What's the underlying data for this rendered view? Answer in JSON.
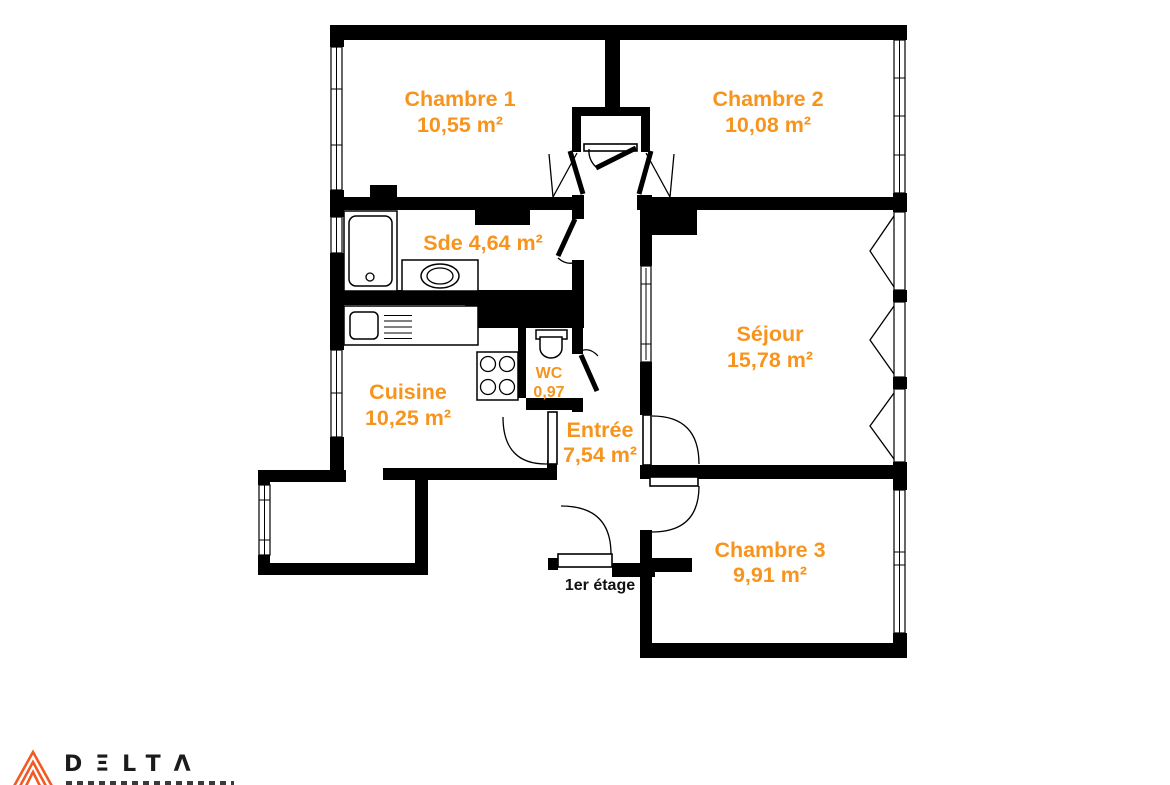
{
  "plan": {
    "floor_label": "1er étage",
    "rooms": {
      "chambre1": {
        "name": "Chambre 1",
        "area": "10,55 m²"
      },
      "chambre2": {
        "name": "Chambre 2",
        "area": "10,08 m²"
      },
      "sde": {
        "label": "Sde 4,64 m²"
      },
      "sejour": {
        "name": "Séjour",
        "area": "15,78 m²"
      },
      "cuisine": {
        "name": "Cuisine",
        "area": "10,25 m²"
      },
      "wc": {
        "name": "WC",
        "area": "0,97"
      },
      "entree": {
        "name": "Entrée",
        "area": "7,54 m²"
      },
      "chambre3": {
        "name": "Chambre 3",
        "area": "9,91 m²"
      }
    }
  },
  "logo": {
    "brand": "DELTA",
    "letters": [
      "D",
      "Ξ",
      "L",
      "T",
      "Λ"
    ]
  },
  "colors": {
    "label_orange": "#F7941E",
    "wall_black": "#000000",
    "logo_orange": "#F15A24"
  }
}
